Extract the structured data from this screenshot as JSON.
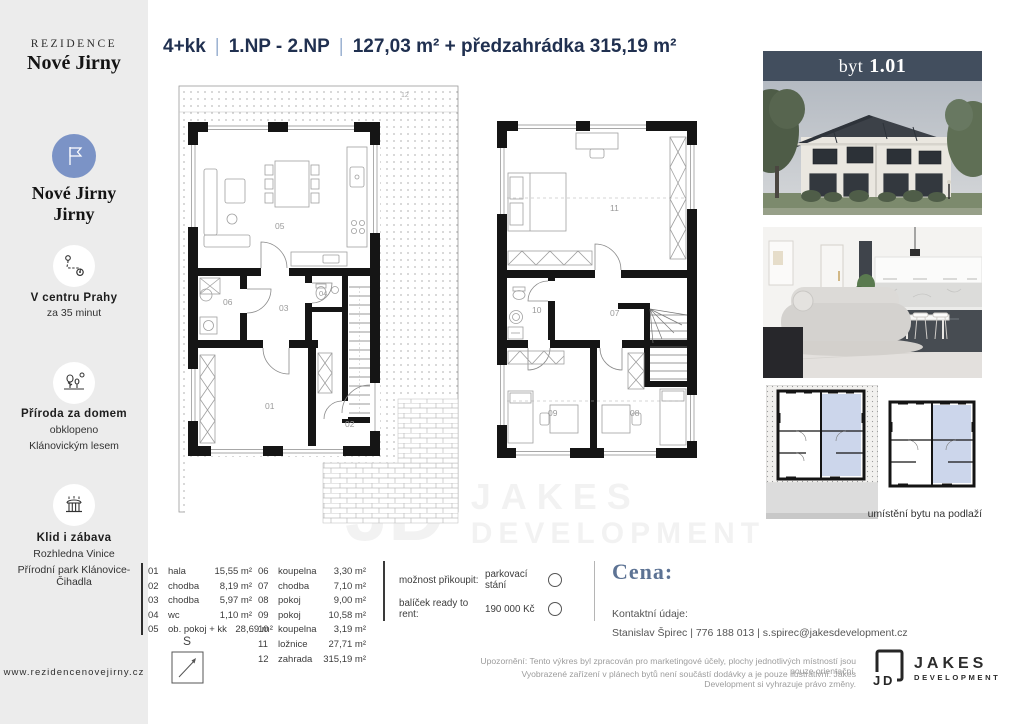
{
  "sidebar": {
    "brand_top": "REZIDENCE",
    "brand_name": "Nové Jirny",
    "loc_line1": "Nové Jirny",
    "loc_line2": "Jirny",
    "features": [
      {
        "title": "V centru Prahy",
        "line1": "za 35 minut",
        "line2": ""
      },
      {
        "title": "Příroda za domem",
        "line1": "obklopeno",
        "line2": "Klánovickým lesem"
      },
      {
        "title": "Klid i zábava",
        "line1": "Rozhledna Vinice",
        "line2": "Přírodní park Klánovice-Čihadla"
      }
    ],
    "website": "www.rezidencenovejirny.cz"
  },
  "header": {
    "part1": "4+kk",
    "sep": "|",
    "part2": "1.NP - 2.NP",
    "part3": "127,03 m² + předzahrádka 315,19 m²"
  },
  "unit": {
    "prefix": "byt",
    "number": "1.01"
  },
  "plans": {
    "compass": "S",
    "caption": "umístění bytu na podlaží",
    "p1": {
      "r01": "01",
      "r02": "02",
      "r03": "03",
      "r04": "04",
      "r05": "05",
      "r06": "06",
      "r12": "12"
    },
    "p2": {
      "r07": "07",
      "r08": "08",
      "r09": "09",
      "r10": "10",
      "r11": "11"
    }
  },
  "legend": {
    "col1": [
      {
        "num": "01",
        "name": "hala",
        "area": "15,55 m²"
      },
      {
        "num": "02",
        "name": "chodba",
        "area": "8,19 m²"
      },
      {
        "num": "03",
        "name": "chodba",
        "area": "5,97 m²"
      },
      {
        "num": "04",
        "name": "wc",
        "area": "1,10 m²"
      },
      {
        "num": "05",
        "name": "ob. pokoj + kk",
        "area": "28,69 m²"
      }
    ],
    "col2": [
      {
        "num": "06",
        "name": "koupelna",
        "area": "3,30 m²"
      },
      {
        "num": "07",
        "name": "chodba",
        "area": "7,10 m²"
      },
      {
        "num": "08",
        "name": "pokoj",
        "area": "9,00 m²"
      },
      {
        "num": "09",
        "name": "pokoj",
        "area": "10,58 m²"
      },
      {
        "num": "10",
        "name": "koupelna",
        "area": "3,19 m²"
      },
      {
        "num": "11",
        "name": "ložnice",
        "area": "27,71 m²"
      },
      {
        "num": "12",
        "name": "zahrada",
        "area": "315,19 m²"
      }
    ]
  },
  "options": [
    {
      "label": "možnost přikoupit:",
      "value": "parkovací stání"
    },
    {
      "label": "balíček ready to rent:",
      "value": "190 000 Kč"
    }
  ],
  "price": {
    "title": "Cena:",
    "contact_label": "Kontaktní údaje:",
    "contact": "Stanislav Špirec | 776 188 013 | s.spirec@jakesdevelopment.cz"
  },
  "footer": {
    "disclaimer1": "Upozornění: Tento výkres byl zpracován pro marketingové účely, plochy jednotlivých místností jsou pouze orientační.",
    "disclaimer2": "Vyobrazené zařízení v plánech bytů není součástí dodávky a je pouze ilustrativní. Jakes Development si vyhrazuje právo změny.",
    "logo_monogram": "JD",
    "logo_name": "JAKES",
    "logo_sub": "DEVELOPMENT"
  },
  "watermark": {
    "mono": "JD",
    "name": "JAKES",
    "sub": "DEVELOPMENT"
  },
  "colors": {
    "accent_navy": "#203050",
    "separator_blue": "#9db3d1",
    "brand_blue_circle": "#7b93c6",
    "unit_bar_slate": "#424e5e",
    "price_blue": "#5d7394",
    "plan_highlight": "#cdd7eb",
    "sidebar_gray": "#ececec"
  }
}
